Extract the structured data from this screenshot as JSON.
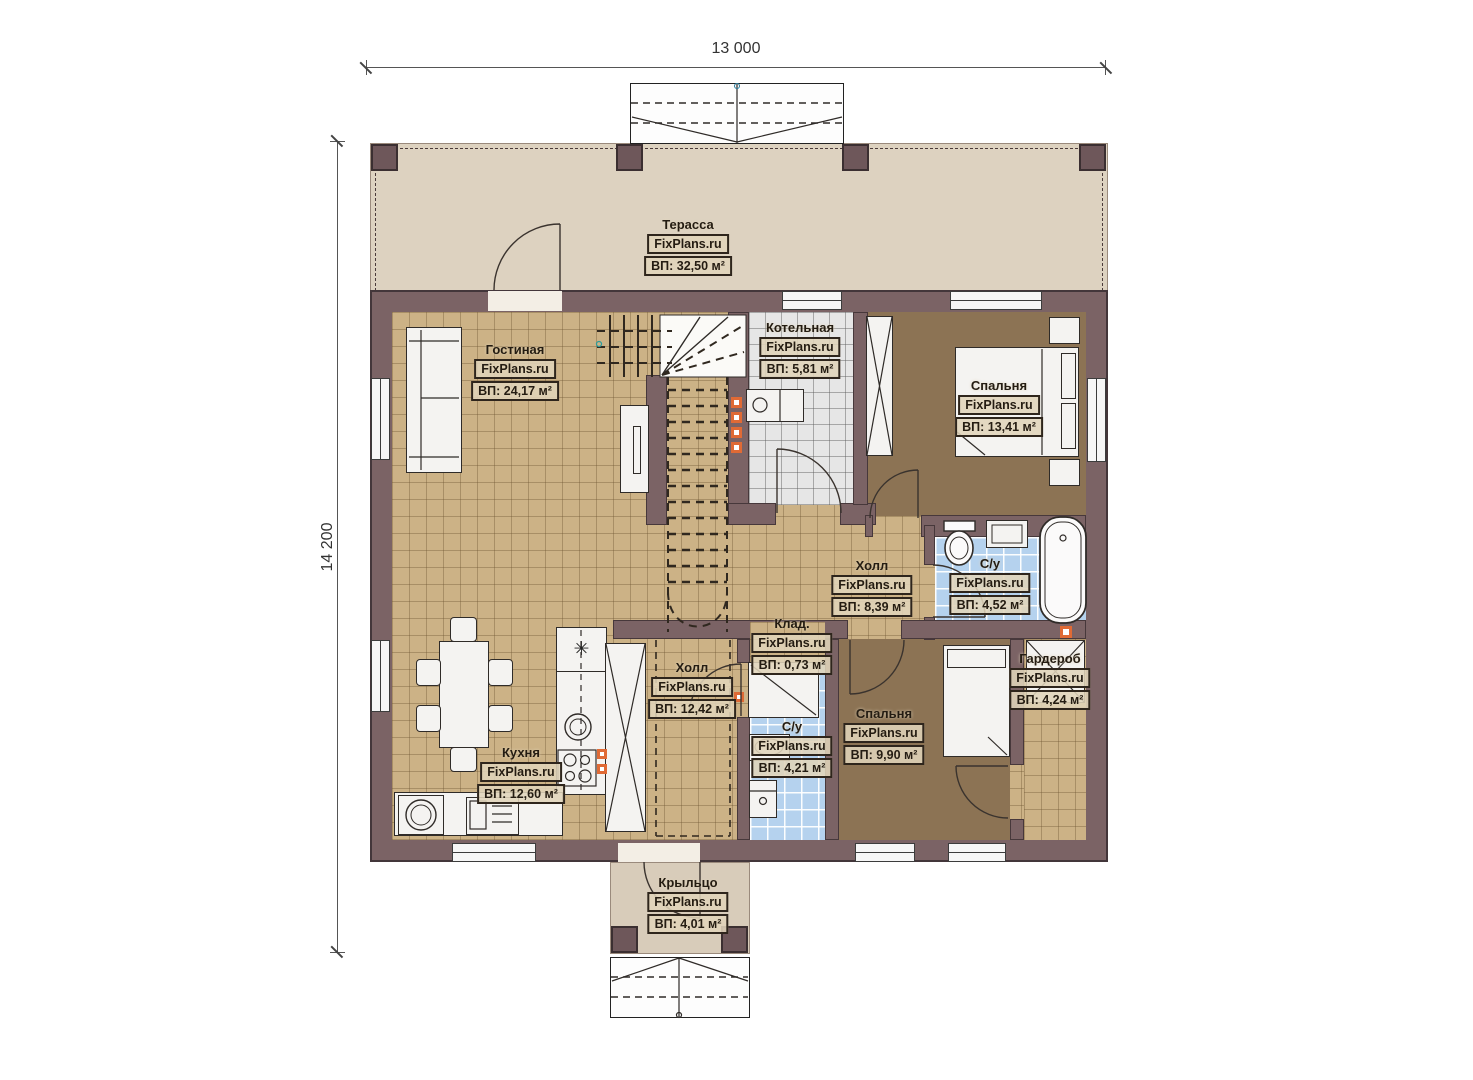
{
  "dimensions": {
    "width_label": "13 000",
    "height_label": "14 200"
  },
  "watermark": "FixPlans.ru",
  "rooms": [
    {
      "name": "Терасса",
      "area": "ВП: 32,50 м²"
    },
    {
      "name": "Гостиная",
      "area": "ВП: 24,17 м²"
    },
    {
      "name": "Котельная",
      "area": "ВП: 5,81 м²"
    },
    {
      "name": "Спальня",
      "area": "ВП: 13,41 м²"
    },
    {
      "name": "Холл",
      "area": "ВП: 8,39 м²"
    },
    {
      "name": "С/у",
      "area": "ВП: 4,52 м²"
    },
    {
      "name": "Клад.",
      "area": "ВП: 0,73 м²"
    },
    {
      "name": "Холл",
      "area": "ВП: 12,42 м²"
    },
    {
      "name": "С/у",
      "area": "ВП: 4,21 м²"
    },
    {
      "name": "Спальня",
      "area": "ВП: 9,90 м²"
    },
    {
      "name": "Гардероб",
      "area": "ВП: 4,24 м²"
    },
    {
      "name": "Кухня",
      "area": "ВП: 12,60 м²"
    },
    {
      "name": "Крыльцо",
      "area": "ВП: 4,01 м²"
    }
  ],
  "icons": {
    "fridge_star": "✳"
  },
  "colors": {
    "wall": "#7b6365",
    "wall_outline": "#43363a",
    "floor_tile_tan": "#ccb286",
    "floor_wood_brown": "#8c7354",
    "floor_tile_blue": "#b5d2ee",
    "floor_tile_gray": "#e6e6e6",
    "terrace_deck": "#ddd2c0",
    "marker_orange": "#e06a35"
  }
}
